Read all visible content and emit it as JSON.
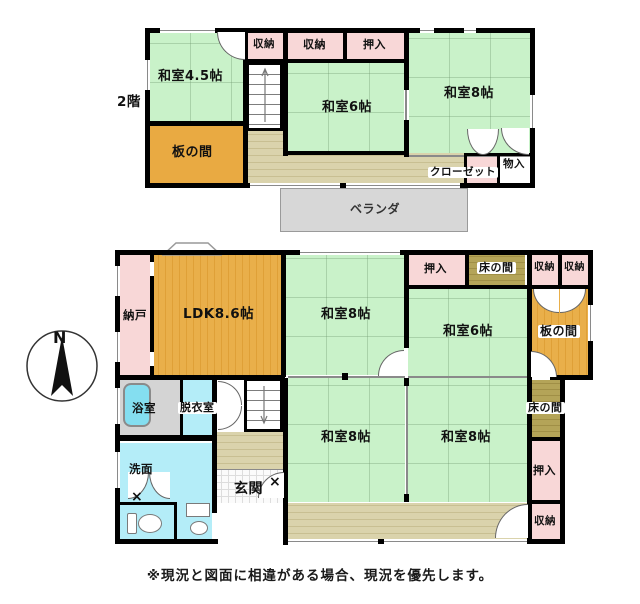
{
  "caption": "※現況と図面に相違がある場合、現況を優先します。",
  "compass": {
    "north_label": "N"
  },
  "symbols": {
    "door_mark": "×"
  },
  "floor2": {
    "floor_label": "2階",
    "washitsu_45": "和室4.5帖",
    "shuno_left": "収納",
    "shuno_mid": "収納",
    "oshiire": "押入",
    "washitsu_6": "和室6帖",
    "washitsu_8": "和室8帖",
    "itanoma": "板の間",
    "closet": "クローゼット",
    "monoire": "物入",
    "veranda": "ベランダ"
  },
  "floor1": {
    "nando": "納戸",
    "ldk": "LDK8.6帖",
    "washitsu_8_top": "和室8帖",
    "oshiire_top": "押入",
    "tokonoma_top": "床の間",
    "shuno_top_left": "収納",
    "shuno_top_right": "収納",
    "washitsu_6": "和室6帖",
    "itanoma": "板の間",
    "yokushitsu": "浴室",
    "datsuishitsu": "脱衣室",
    "senmen": "洗面",
    "genkan": "玄関",
    "washitsu_8_left": "和室8帖",
    "washitsu_8_right": "和室8帖",
    "tokonoma_right": "床の間",
    "oshiire_right": "押入",
    "shuno_bottom": "収納"
  },
  "colors": {
    "tatami_green": "#c9f2c9",
    "closet_pink": "#f8d7d7",
    "wood_orange": "#e9aa42",
    "tokonoma_khaki": "#b2a257",
    "corridor_tan": "#d9d2ab",
    "veranda_gray": "#d7d7d7",
    "wet_area_cyan": "#b4edf8",
    "bath_gray": "#d4d4d4",
    "wall_black": "#000000"
  }
}
